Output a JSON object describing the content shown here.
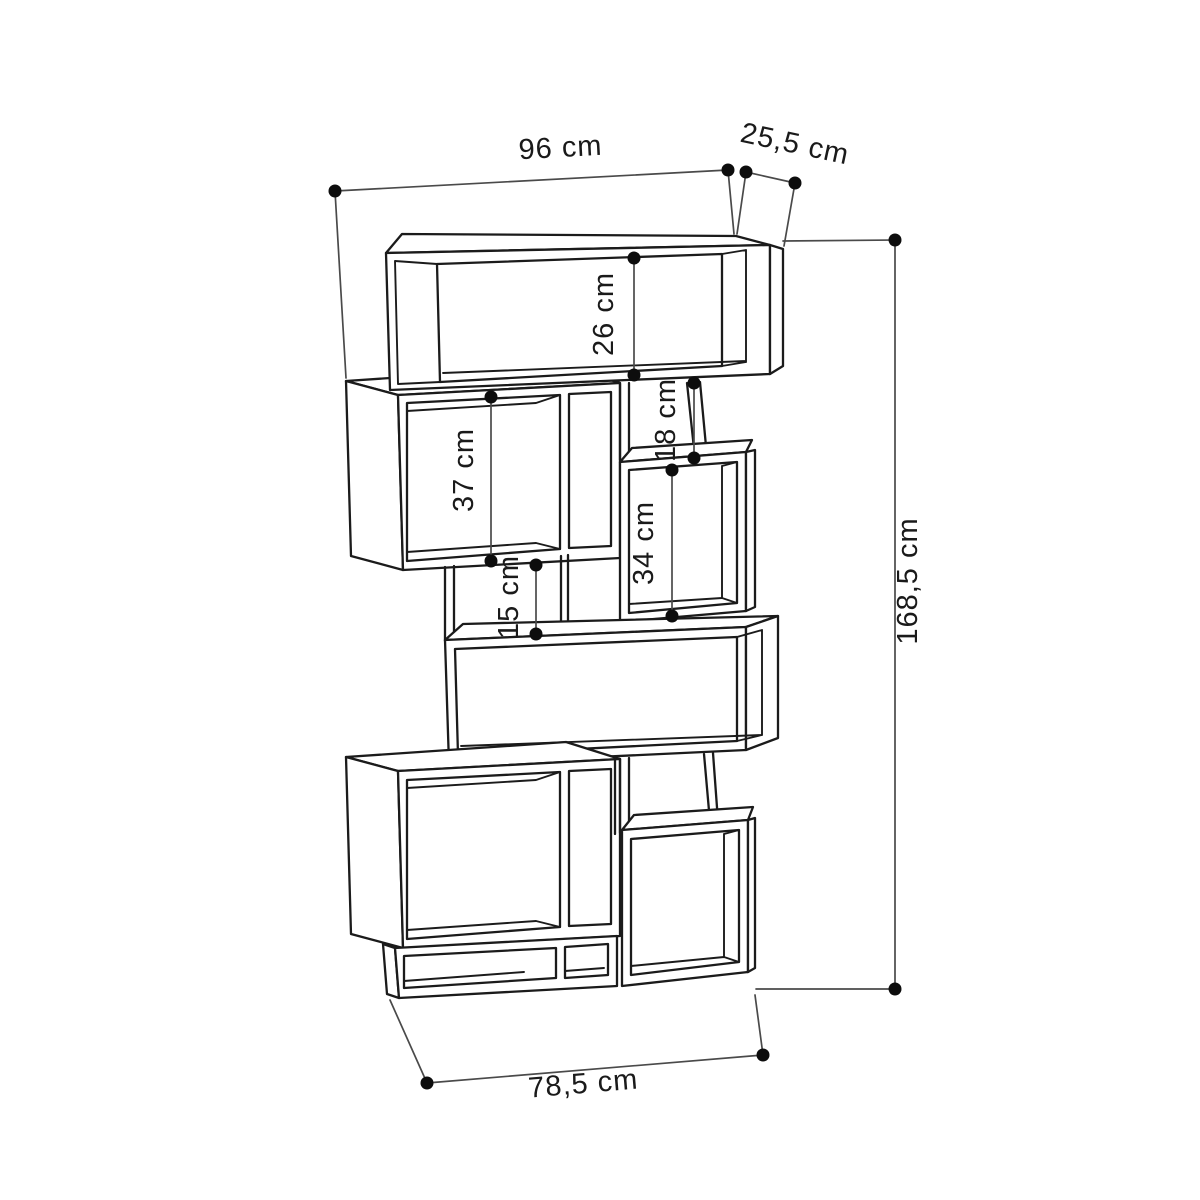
{
  "diagram": {
    "kind": "furniture-dimension-drawing",
    "subject": "staggered zigzag bookcase, open compartments, line drawing with dimension callouts",
    "units": "cm",
    "background_color": "#ffffff",
    "line_color": "#1b1b1b",
    "dimension_line_color": "#4a4a4a",
    "labels": {
      "width_top": "96 cm",
      "depth": "25,5 cm",
      "shelf_top": "26 cm",
      "gap_upper": "18 cm",
      "shelf_left": "37 cm",
      "shelf_right": "34 cm",
      "gap_middle": "15 cm",
      "height": "168,5 cm",
      "width_base": "78,5 cm"
    },
    "dimensions_cm": {
      "overall_width": 96,
      "depth": 25.5,
      "overall_height": 168.5,
      "base_width": 78.5,
      "top_compartment_height": 26,
      "upper_right_gap_height": 18,
      "upper_left_compartment_height": 37,
      "middle_right_compartment_height": 34,
      "middle_left_gap_height": 15
    }
  }
}
